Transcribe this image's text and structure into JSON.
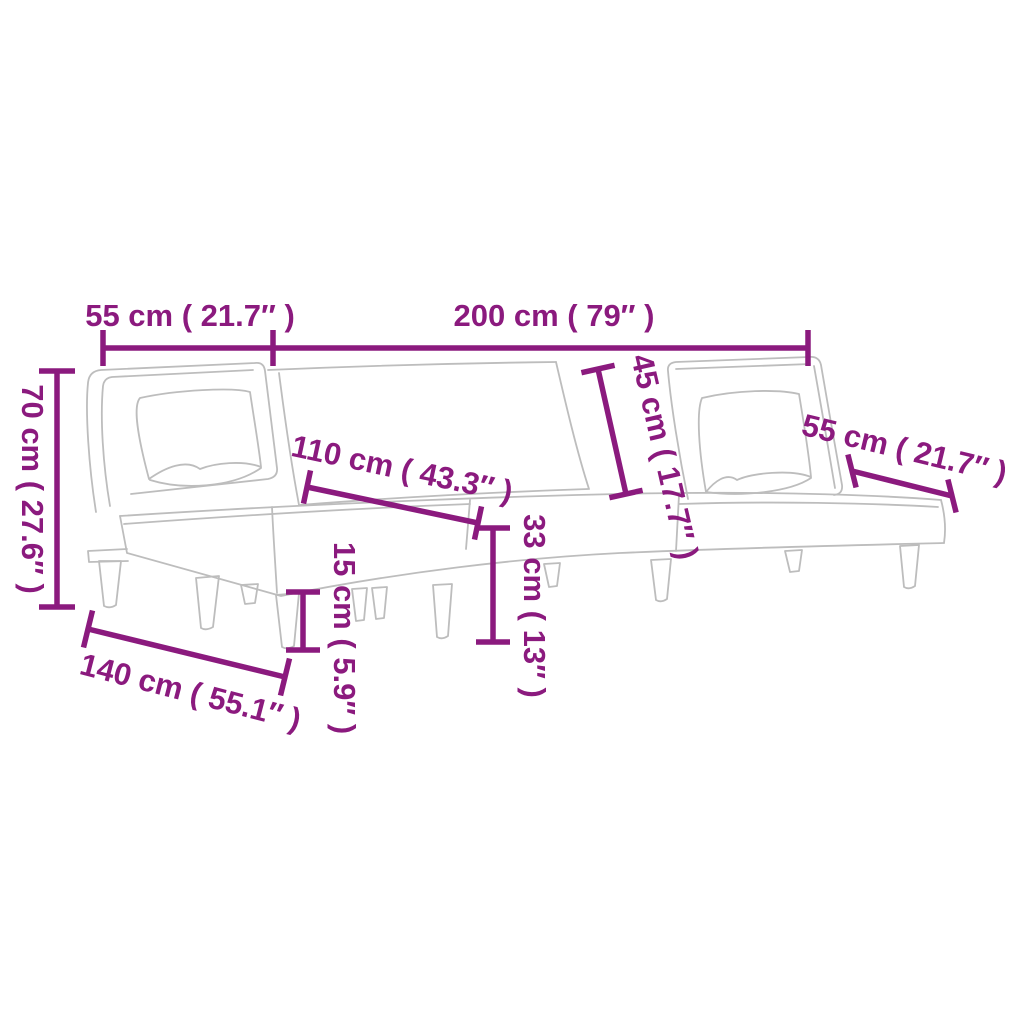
{
  "diagram": {
    "title": "L-shaped sofa bed dimension diagram",
    "product": "l-shaped-sofa-bed-line-drawing",
    "colors": {
      "accent": "#8B1A7E",
      "outline": "#BDBDBD",
      "background": "#FFFFFF"
    },
    "dimensions": [
      {
        "name": "left-section-back-width",
        "cm": 55,
        "inch": 21.7,
        "label": "55 cm ( 21.7″ )"
      },
      {
        "name": "total-back-width",
        "cm": 200,
        "inch": 79,
        "label": "200 cm ( 79″ )"
      },
      {
        "name": "back-height",
        "cm": 70,
        "inch": 27.6,
        "label": "70 cm ( 27.6″ )"
      },
      {
        "name": "chaise-length",
        "cm": 110,
        "inch": 43.3,
        "label": "110 cm ( 43.3″ )"
      },
      {
        "name": "backrest-length",
        "cm": 45,
        "inch": 17.7,
        "label": "45 cm ( 17.7″ )"
      },
      {
        "name": "right-seat-depth",
        "cm": 55,
        "inch": 21.7,
        "label": "55 cm ( 21.7″ )"
      },
      {
        "name": "seat-height",
        "cm": 33,
        "inch": 13,
        "label": "33 cm ( 13″ )"
      },
      {
        "name": "leg-height",
        "cm": 15,
        "inch": 5.9,
        "label": "15 cm ( 5.9″ )"
      },
      {
        "name": "total-depth",
        "cm": 140,
        "inch": 55.1,
        "label": "140 cm ( 55.1″ )"
      }
    ]
  }
}
